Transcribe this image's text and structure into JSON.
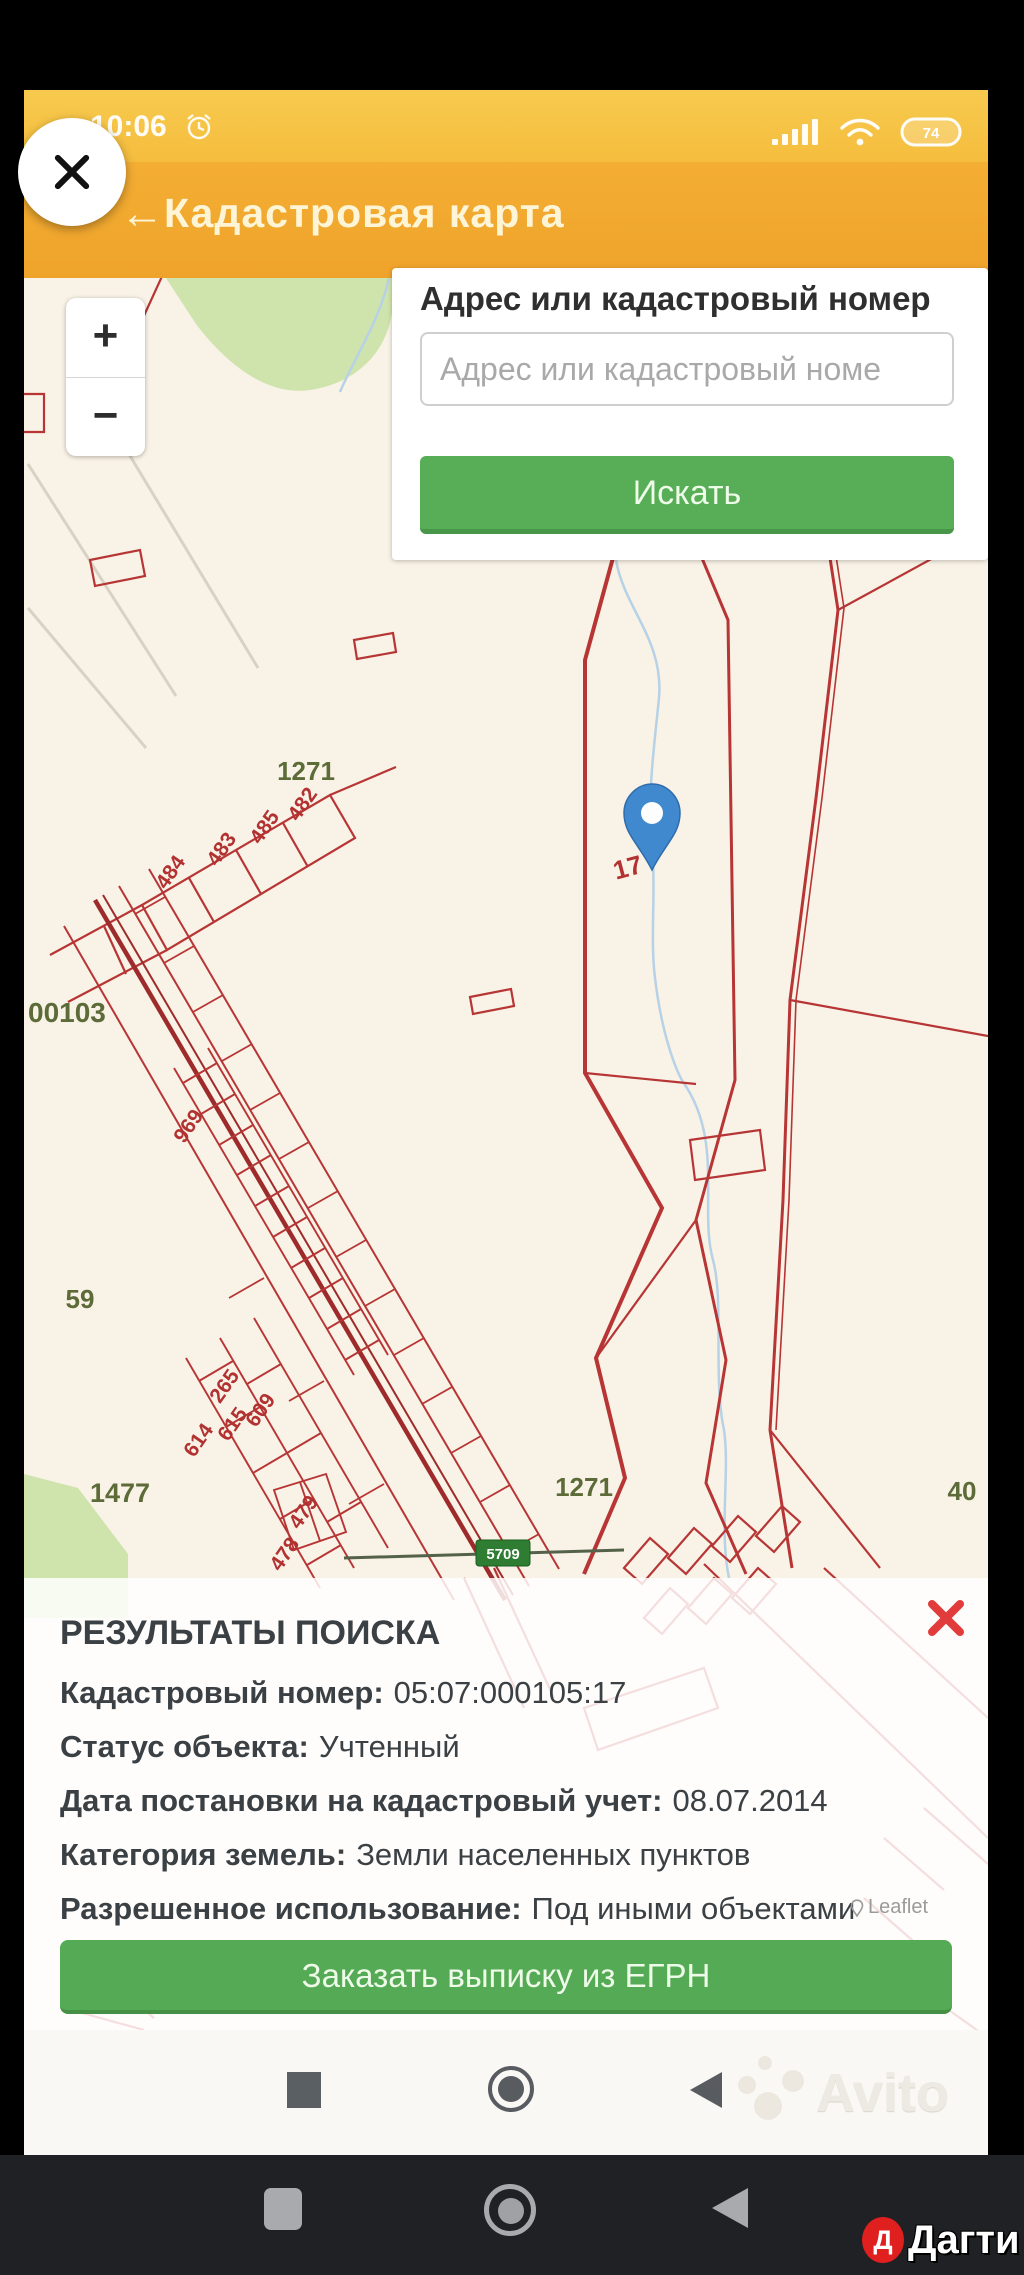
{
  "status_bar": {
    "time": "10:06",
    "battery_percent": "74"
  },
  "header": {
    "back_glyph": "←",
    "title": "Кадастровая карта"
  },
  "search": {
    "label": "Адрес или кадастровый номер",
    "placeholder": "Адрес или кадастровый номе",
    "button": "Искать"
  },
  "zoom_control": {
    "zoom_in": "+",
    "zoom_out": "−"
  },
  "map": {
    "road_sign": "5709",
    "attribution": "Leaflet",
    "labels": [
      {
        "text": "1271"
      },
      {
        "text": "482"
      },
      {
        "text": "485"
      },
      {
        "text": "483"
      },
      {
        "text": "484"
      },
      {
        "text": "00103"
      },
      {
        "text": "969"
      },
      {
        "text": "59"
      },
      {
        "text": "265"
      },
      {
        "text": "615"
      },
      {
        "text": "614"
      },
      {
        "text": "609"
      },
      {
        "text": "1477"
      },
      {
        "text": "479"
      },
      {
        "text": "478"
      },
      {
        "text": "1271"
      },
      {
        "text": "40"
      },
      {
        "text": "17"
      }
    ]
  },
  "results": {
    "heading": "РЕЗУЛЬТАТЫ ПОИСКА",
    "rows": [
      {
        "label": "Кадастровый номер:",
        "value": "05:07:000105:17"
      },
      {
        "label": "Статус объекта:",
        "value": "Учтенный"
      },
      {
        "label": "Дата постановки на кадастровый учет:",
        "value": "08.07.2014"
      },
      {
        "label": "Категория земель:",
        "value": "Земли населенных пунктов"
      },
      {
        "label": "Разрешенное использование:",
        "value": "Под иными объектами"
      }
    ],
    "order_button": "Заказать выписку из ЕГРН"
  },
  "app_navbar": {
    "watermark": "Avito"
  },
  "phone_navbar": {
    "watermark_initial": "Д",
    "watermark": "Дагти"
  },
  "colors": {
    "accent_green": "#57ae57",
    "header_orange": "#f0a42c",
    "parcel_red": "#b73535",
    "pin_blue": "#4189cf"
  }
}
